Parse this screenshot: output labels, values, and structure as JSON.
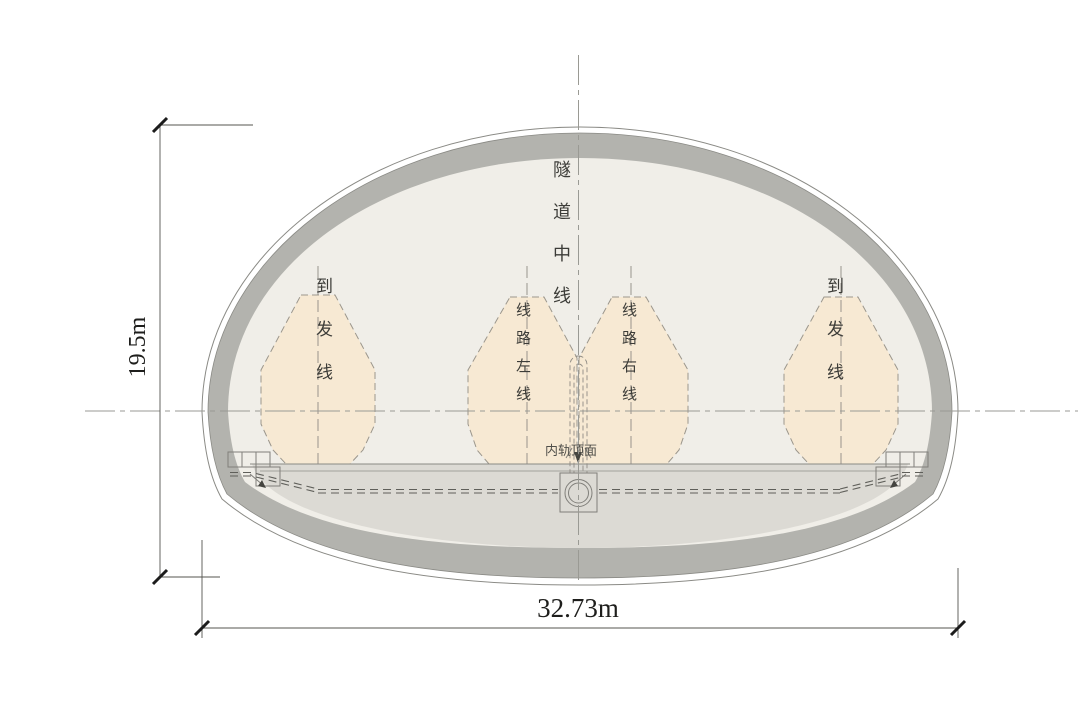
{
  "diagram": {
    "type": "tunnel-cross-section",
    "labels": {
      "tunnel_centerline": "隧道中线",
      "siding_left": "到发线",
      "main_line_left": "线路左线",
      "main_line_right": "线路右线",
      "siding_right": "到发线",
      "rail_top_surface": "内轨顶面"
    },
    "dimensions": {
      "height": "19.5m",
      "width": "32.73m"
    },
    "colors": {
      "outline": "#8a8a85",
      "lining": "#b3b3ae",
      "interior": "#f0eee8",
      "invert": "#dcdad4",
      "envelope_fill": "#f7e9d3",
      "envelope_stroke": "#9b968c"
    }
  }
}
